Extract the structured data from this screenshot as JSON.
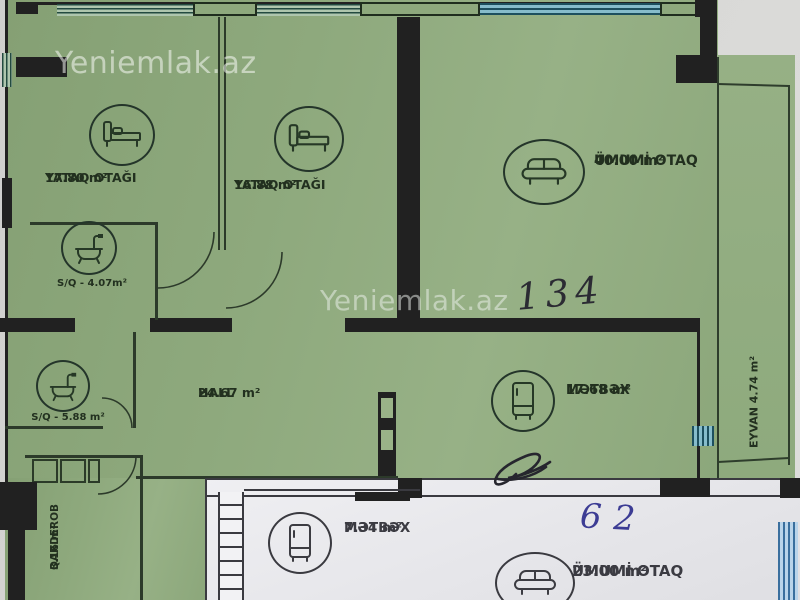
{
  "source": {
    "watermark": "Yeniemlak.az"
  },
  "green_plan": {
    "rooms": {
      "bedroom_1": {
        "name": "YATAQ OTAĞI",
        "area": "17.80 m²"
      },
      "bedroom_2": {
        "name": "YATAQ OTAĞI",
        "area": "16.88 m²"
      },
      "living_room": {
        "name": "ÜMUMİ OTAQ",
        "area": "40.00 m²"
      },
      "bathroom_1": {
        "label": "S/Q - 4.07m²"
      },
      "bathroom_2": {
        "label": "S/Q - 5.88 m²"
      },
      "hall": {
        "name": "HALL",
        "area": "24.67 m²"
      },
      "kitchen": {
        "name": "MƏTBƏX",
        "area": "17.68 m²"
      },
      "balcony": {
        "label": "EYVAN 4.74 m²"
      },
      "wardrobe": {
        "name": "QARDEROB",
        "area": "3.16 m²"
      }
    },
    "annotations": {
      "handwritten_number": "134",
      "handwritten_scribble": "84"
    }
  },
  "white_plan": {
    "rooms": {
      "kitchen": {
        "name": "MƏTBƏX",
        "area": "7.34 m²"
      },
      "living_room": {
        "name": "ÜMUMİ OTAQ",
        "area": "23.00 m²"
      }
    },
    "annotations": {
      "handwritten_number": "62"
    }
  },
  "colors": {
    "paper_green": "#8ea97d",
    "paper_white": "#ebebee",
    "wall_dark": "#212121",
    "window_teal": "#86bccb",
    "ink_blue": "#3c3c94",
    "ink_dark": "#2b2b33"
  }
}
